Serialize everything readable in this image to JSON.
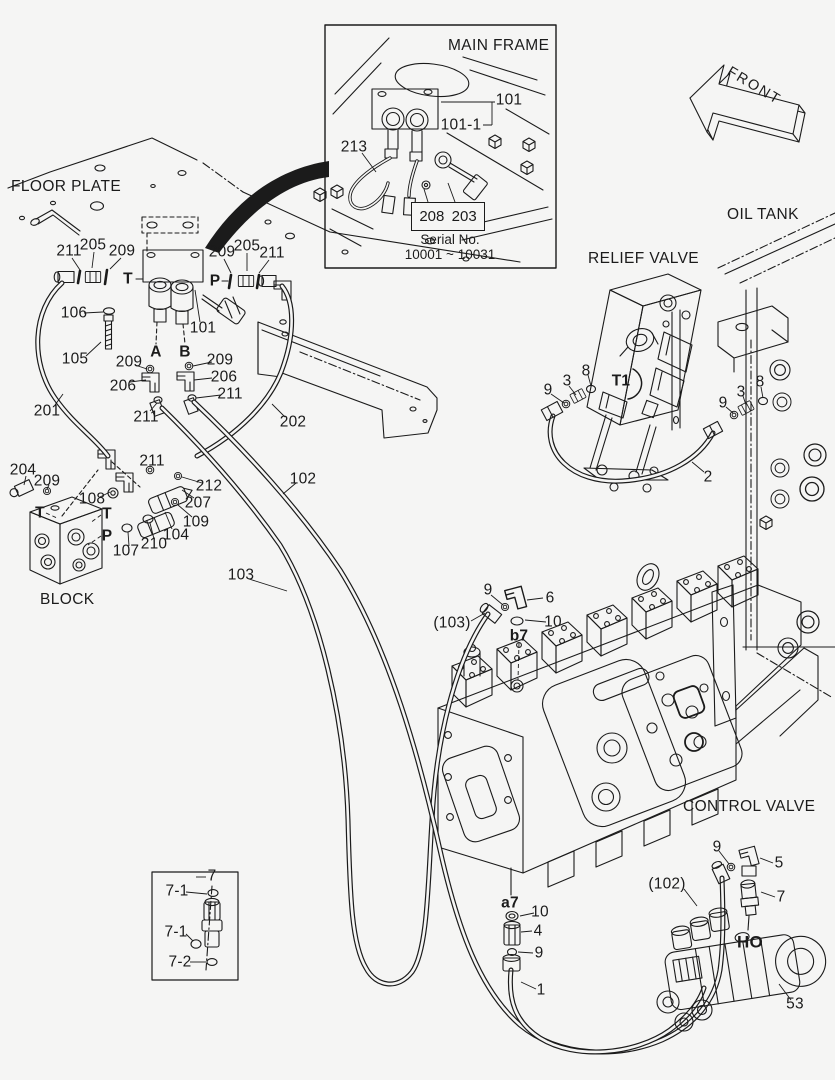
{
  "sections": {
    "floor_plate": "FLOOR PLATE",
    "main_frame": "MAIN FRAME",
    "oil_tank": "OIL TANK",
    "relief_valve": "RELIEF VALVE",
    "control_valve": "CONTROL VALVE",
    "block": "BLOCK",
    "front": "FRONT"
  },
  "inset": {
    "ref_box": [
      "208",
      "203"
    ],
    "serial_caption": "Serial No.",
    "serial_range": "10001 ~ 10031"
  },
  "colors": {
    "ink": "#1b1b1b",
    "paper": "#f5f5f4"
  },
  "callouts": [
    {
      "t": "101",
      "x": 509,
      "y": 100
    },
    {
      "t": "101-1",
      "x": 461,
      "y": 125
    },
    {
      "t": "213",
      "x": 354,
      "y": 147
    },
    {
      "t": "211",
      "x": 69,
      "y": 251
    },
    {
      "t": "205",
      "x": 93,
      "y": 245
    },
    {
      "t": "209",
      "x": 122,
      "y": 251
    },
    {
      "t": "T",
      "x": 128,
      "y": 279,
      "b": true
    },
    {
      "t": "209",
      "x": 222,
      "y": 252
    },
    {
      "t": "205",
      "x": 247,
      "y": 246
    },
    {
      "t": "211",
      "x": 272,
      "y": 253
    },
    {
      "t": "P",
      "x": 215,
      "y": 281,
      "b": true
    },
    {
      "t": "106",
      "x": 74,
      "y": 313
    },
    {
      "t": "105",
      "x": 75,
      "y": 359
    },
    {
      "t": "101",
      "x": 203,
      "y": 328
    },
    {
      "t": "A",
      "x": 156,
      "y": 352,
      "b": true
    },
    {
      "t": "B",
      "x": 185,
      "y": 352,
      "b": true
    },
    {
      "t": "209",
      "x": 129,
      "y": 362
    },
    {
      "t": "209",
      "x": 220,
      "y": 360
    },
    {
      "t": "206",
      "x": 123,
      "y": 386
    },
    {
      "t": "206",
      "x": 224,
      "y": 377
    },
    {
      "t": "211",
      "x": 146,
      "y": 417
    },
    {
      "t": "211",
      "x": 230,
      "y": 394
    },
    {
      "t": "201",
      "x": 47,
      "y": 411
    },
    {
      "t": "202",
      "x": 293,
      "y": 422
    },
    {
      "t": "204",
      "x": 23,
      "y": 470
    },
    {
      "t": "209",
      "x": 47,
      "y": 481
    },
    {
      "t": "T",
      "x": 40,
      "y": 513,
      "b": true
    },
    {
      "t": "108",
      "x": 92,
      "y": 499
    },
    {
      "t": "T",
      "x": 107,
      "y": 514,
      "b": true
    },
    {
      "t": "P",
      "x": 107,
      "y": 536,
      "b": true
    },
    {
      "t": "107",
      "x": 126,
      "y": 551
    },
    {
      "t": "210",
      "x": 154,
      "y": 544
    },
    {
      "t": "104",
      "x": 176,
      "y": 535
    },
    {
      "t": "109",
      "x": 196,
      "y": 522
    },
    {
      "t": "207",
      "x": 198,
      "y": 503
    },
    {
      "t": "212",
      "x": 209,
      "y": 486
    },
    {
      "t": "211",
      "x": 152,
      "y": 461
    },
    {
      "t": "102",
      "x": 303,
      "y": 479
    },
    {
      "t": "103",
      "x": 241,
      "y": 575
    },
    {
      "t": "9",
      "x": 548,
      "y": 390
    },
    {
      "t": "3",
      "x": 567,
      "y": 381
    },
    {
      "t": "8",
      "x": 586,
      "y": 371
    },
    {
      "t": "T1",
      "x": 621,
      "y": 381,
      "b": true
    },
    {
      "t": "9",
      "x": 723,
      "y": 403
    },
    {
      "t": "3",
      "x": 741,
      "y": 392
    },
    {
      "t": "8",
      "x": 760,
      "y": 382
    },
    {
      "t": "2",
      "x": 708,
      "y": 477
    },
    {
      "t": "9",
      "x": 488,
      "y": 590
    },
    {
      "t": "6",
      "x": 550,
      "y": 598
    },
    {
      "t": "(103)",
      "x": 452,
      "y": 623
    },
    {
      "t": "10",
      "x": 553,
      "y": 622
    },
    {
      "t": "b7",
      "x": 519,
      "y": 636,
      "b": true
    },
    {
      "t": "9",
      "x": 717,
      "y": 847
    },
    {
      "t": "5",
      "x": 779,
      "y": 863
    },
    {
      "t": "(102)",
      "x": 667,
      "y": 884
    },
    {
      "t": "7",
      "x": 781,
      "y": 897
    },
    {
      "t": "HO",
      "x": 750,
      "y": 942,
      "b": true,
      "fs": 17
    },
    {
      "t": "53",
      "x": 795,
      "y": 1004
    },
    {
      "t": "a7",
      "x": 510,
      "y": 903,
      "b": true
    },
    {
      "t": "10",
      "x": 540,
      "y": 912
    },
    {
      "t": "4",
      "x": 538,
      "y": 931
    },
    {
      "t": "9",
      "x": 539,
      "y": 953
    },
    {
      "t": "1",
      "x": 541,
      "y": 990
    },
    {
      "t": "7",
      "x": 212,
      "y": 876
    },
    {
      "t": "7-1",
      "x": 177,
      "y": 891
    },
    {
      "t": "7-1",
      "x": 176,
      "y": 932
    },
    {
      "t": "7-2",
      "x": 180,
      "y": 962
    }
  ]
}
